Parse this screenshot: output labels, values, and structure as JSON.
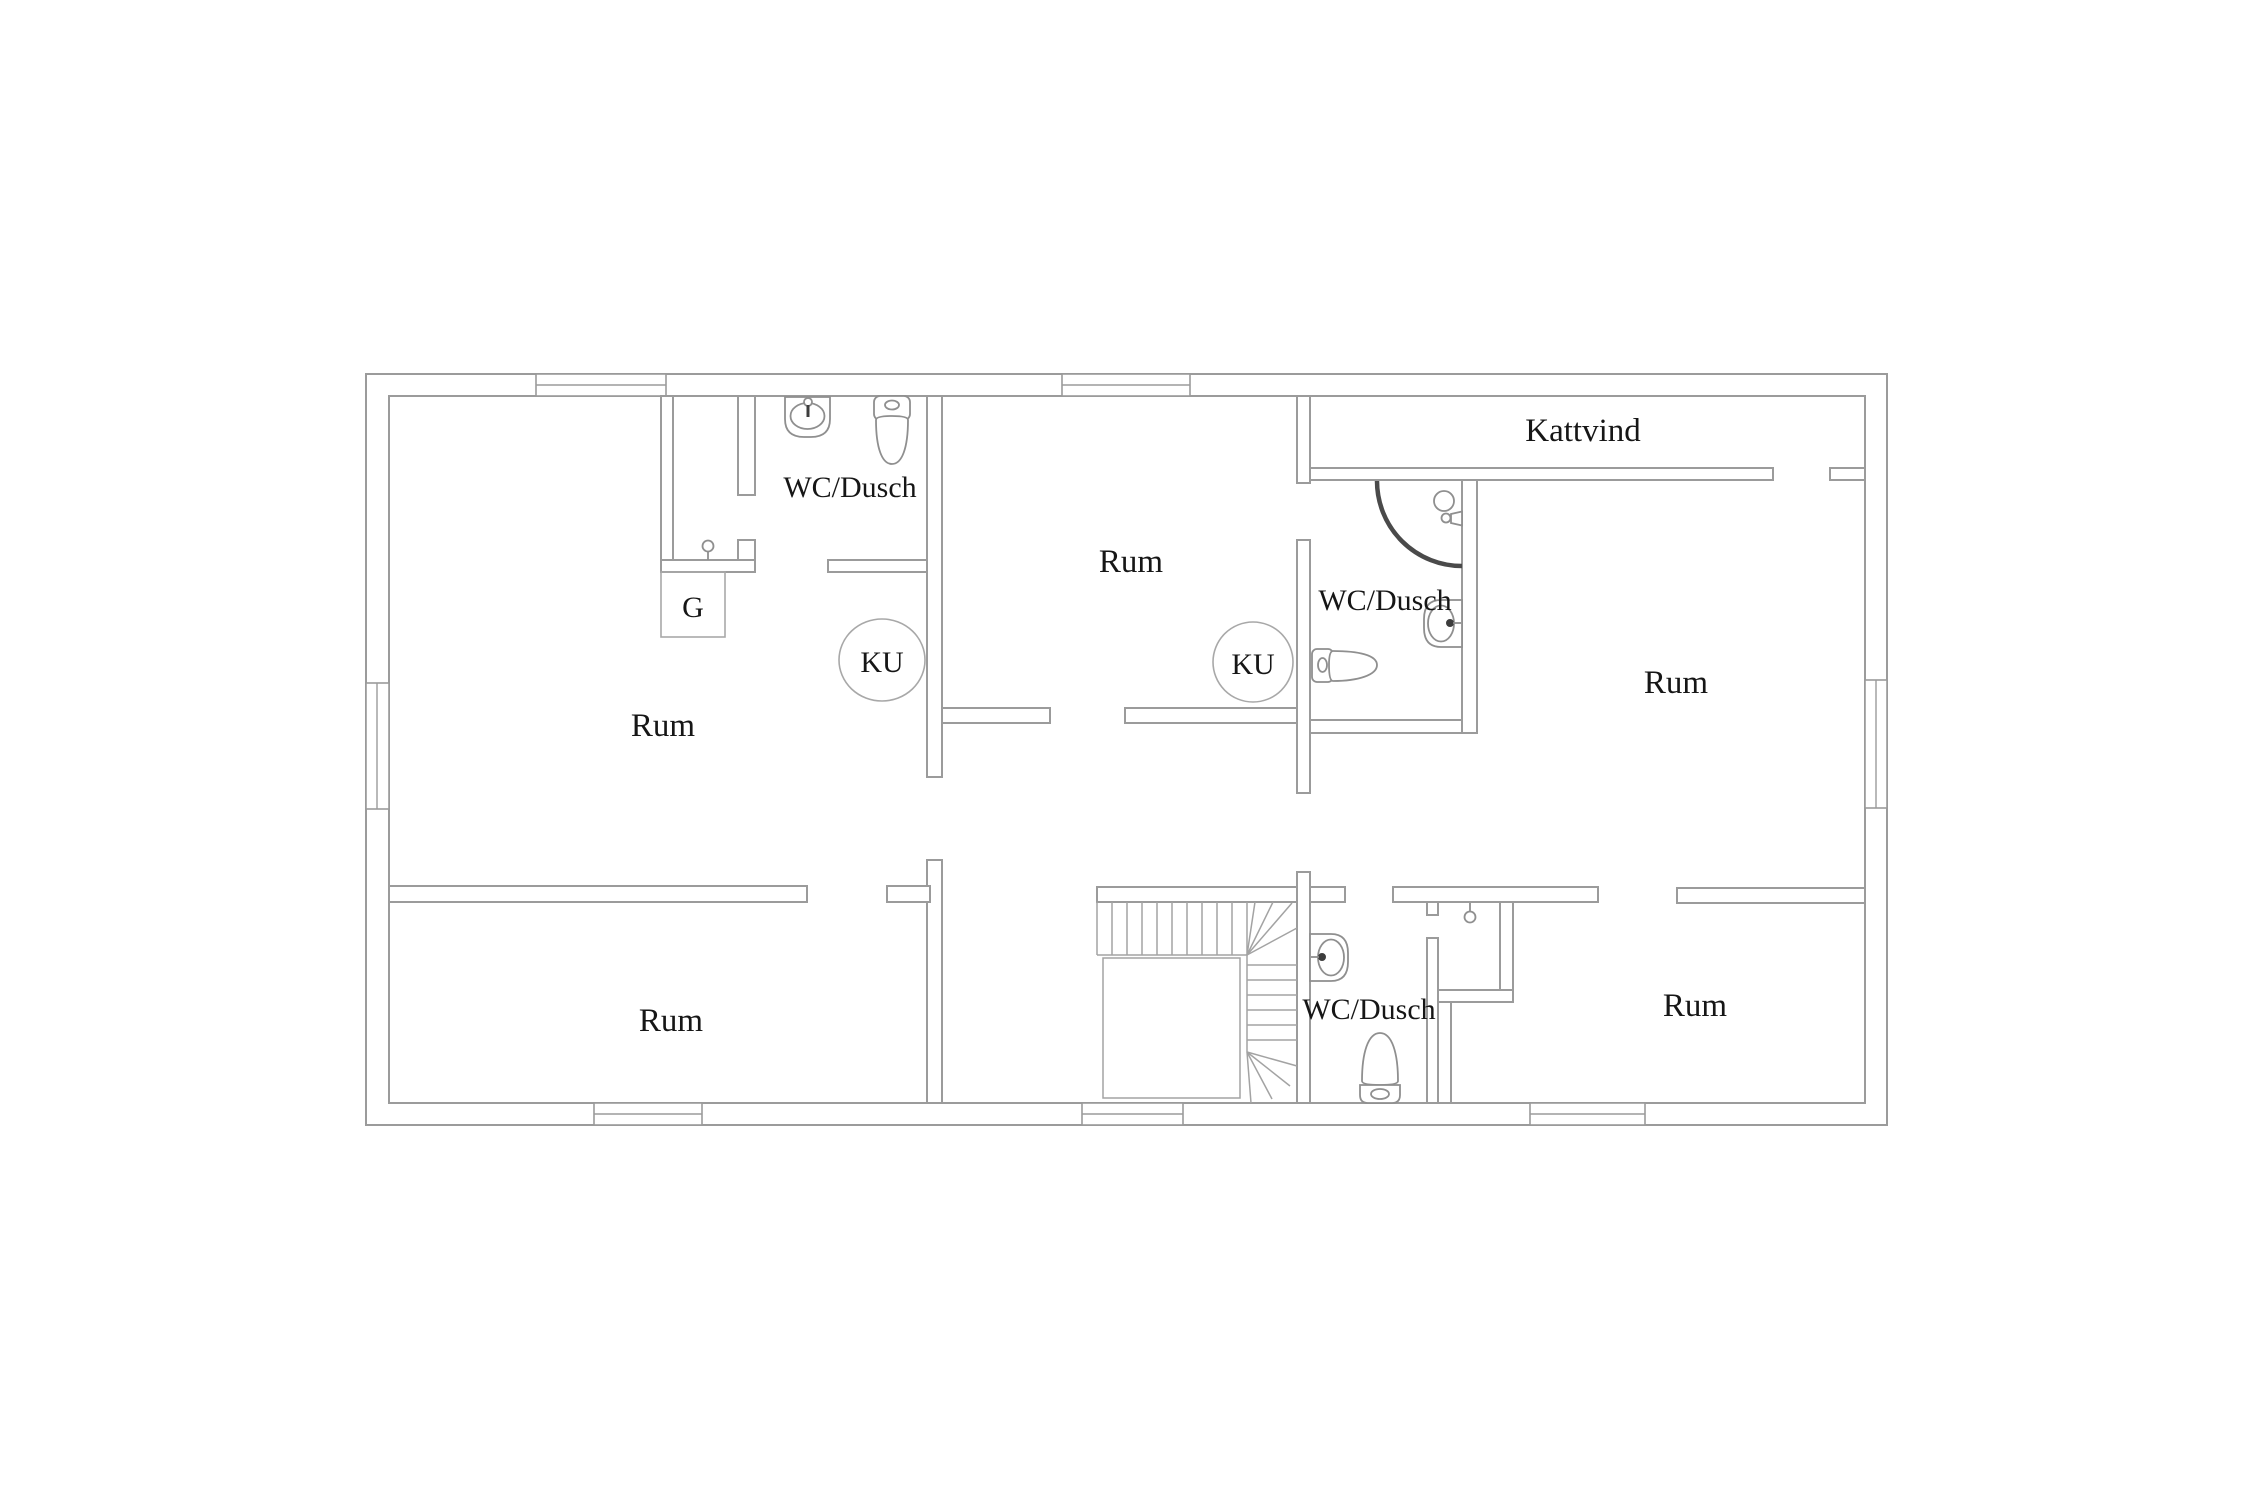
{
  "plan": {
    "labels": {
      "room_top_left": "Rum",
      "room_middle": "Rum",
      "room_right": "Rum",
      "room_bottom_left": "Rum",
      "room_bottom_right": "Rum",
      "bath_top_left": "WC/Dusch",
      "bath_middle": "WC/Dusch",
      "bath_bottom": "WC/Dusch",
      "attic": "Kattvind",
      "chimney_left": "KU",
      "chimney_right": "KU",
      "wardrobe": "G"
    },
    "colors": {
      "background": "#ffffff",
      "wall_line": "#9b9b9b",
      "fixture_line": "#8f8f8f",
      "shower_arc": "#4a4a4a",
      "text": "#161616"
    },
    "icons": [
      "toilet-icon",
      "sink-icon",
      "shower-head-icon",
      "shower-valve-icon",
      "shower-door-arc",
      "ceiling-hook-icon",
      "staircase",
      "chimney-circle",
      "window-symbol",
      "door-opening"
    ]
  }
}
